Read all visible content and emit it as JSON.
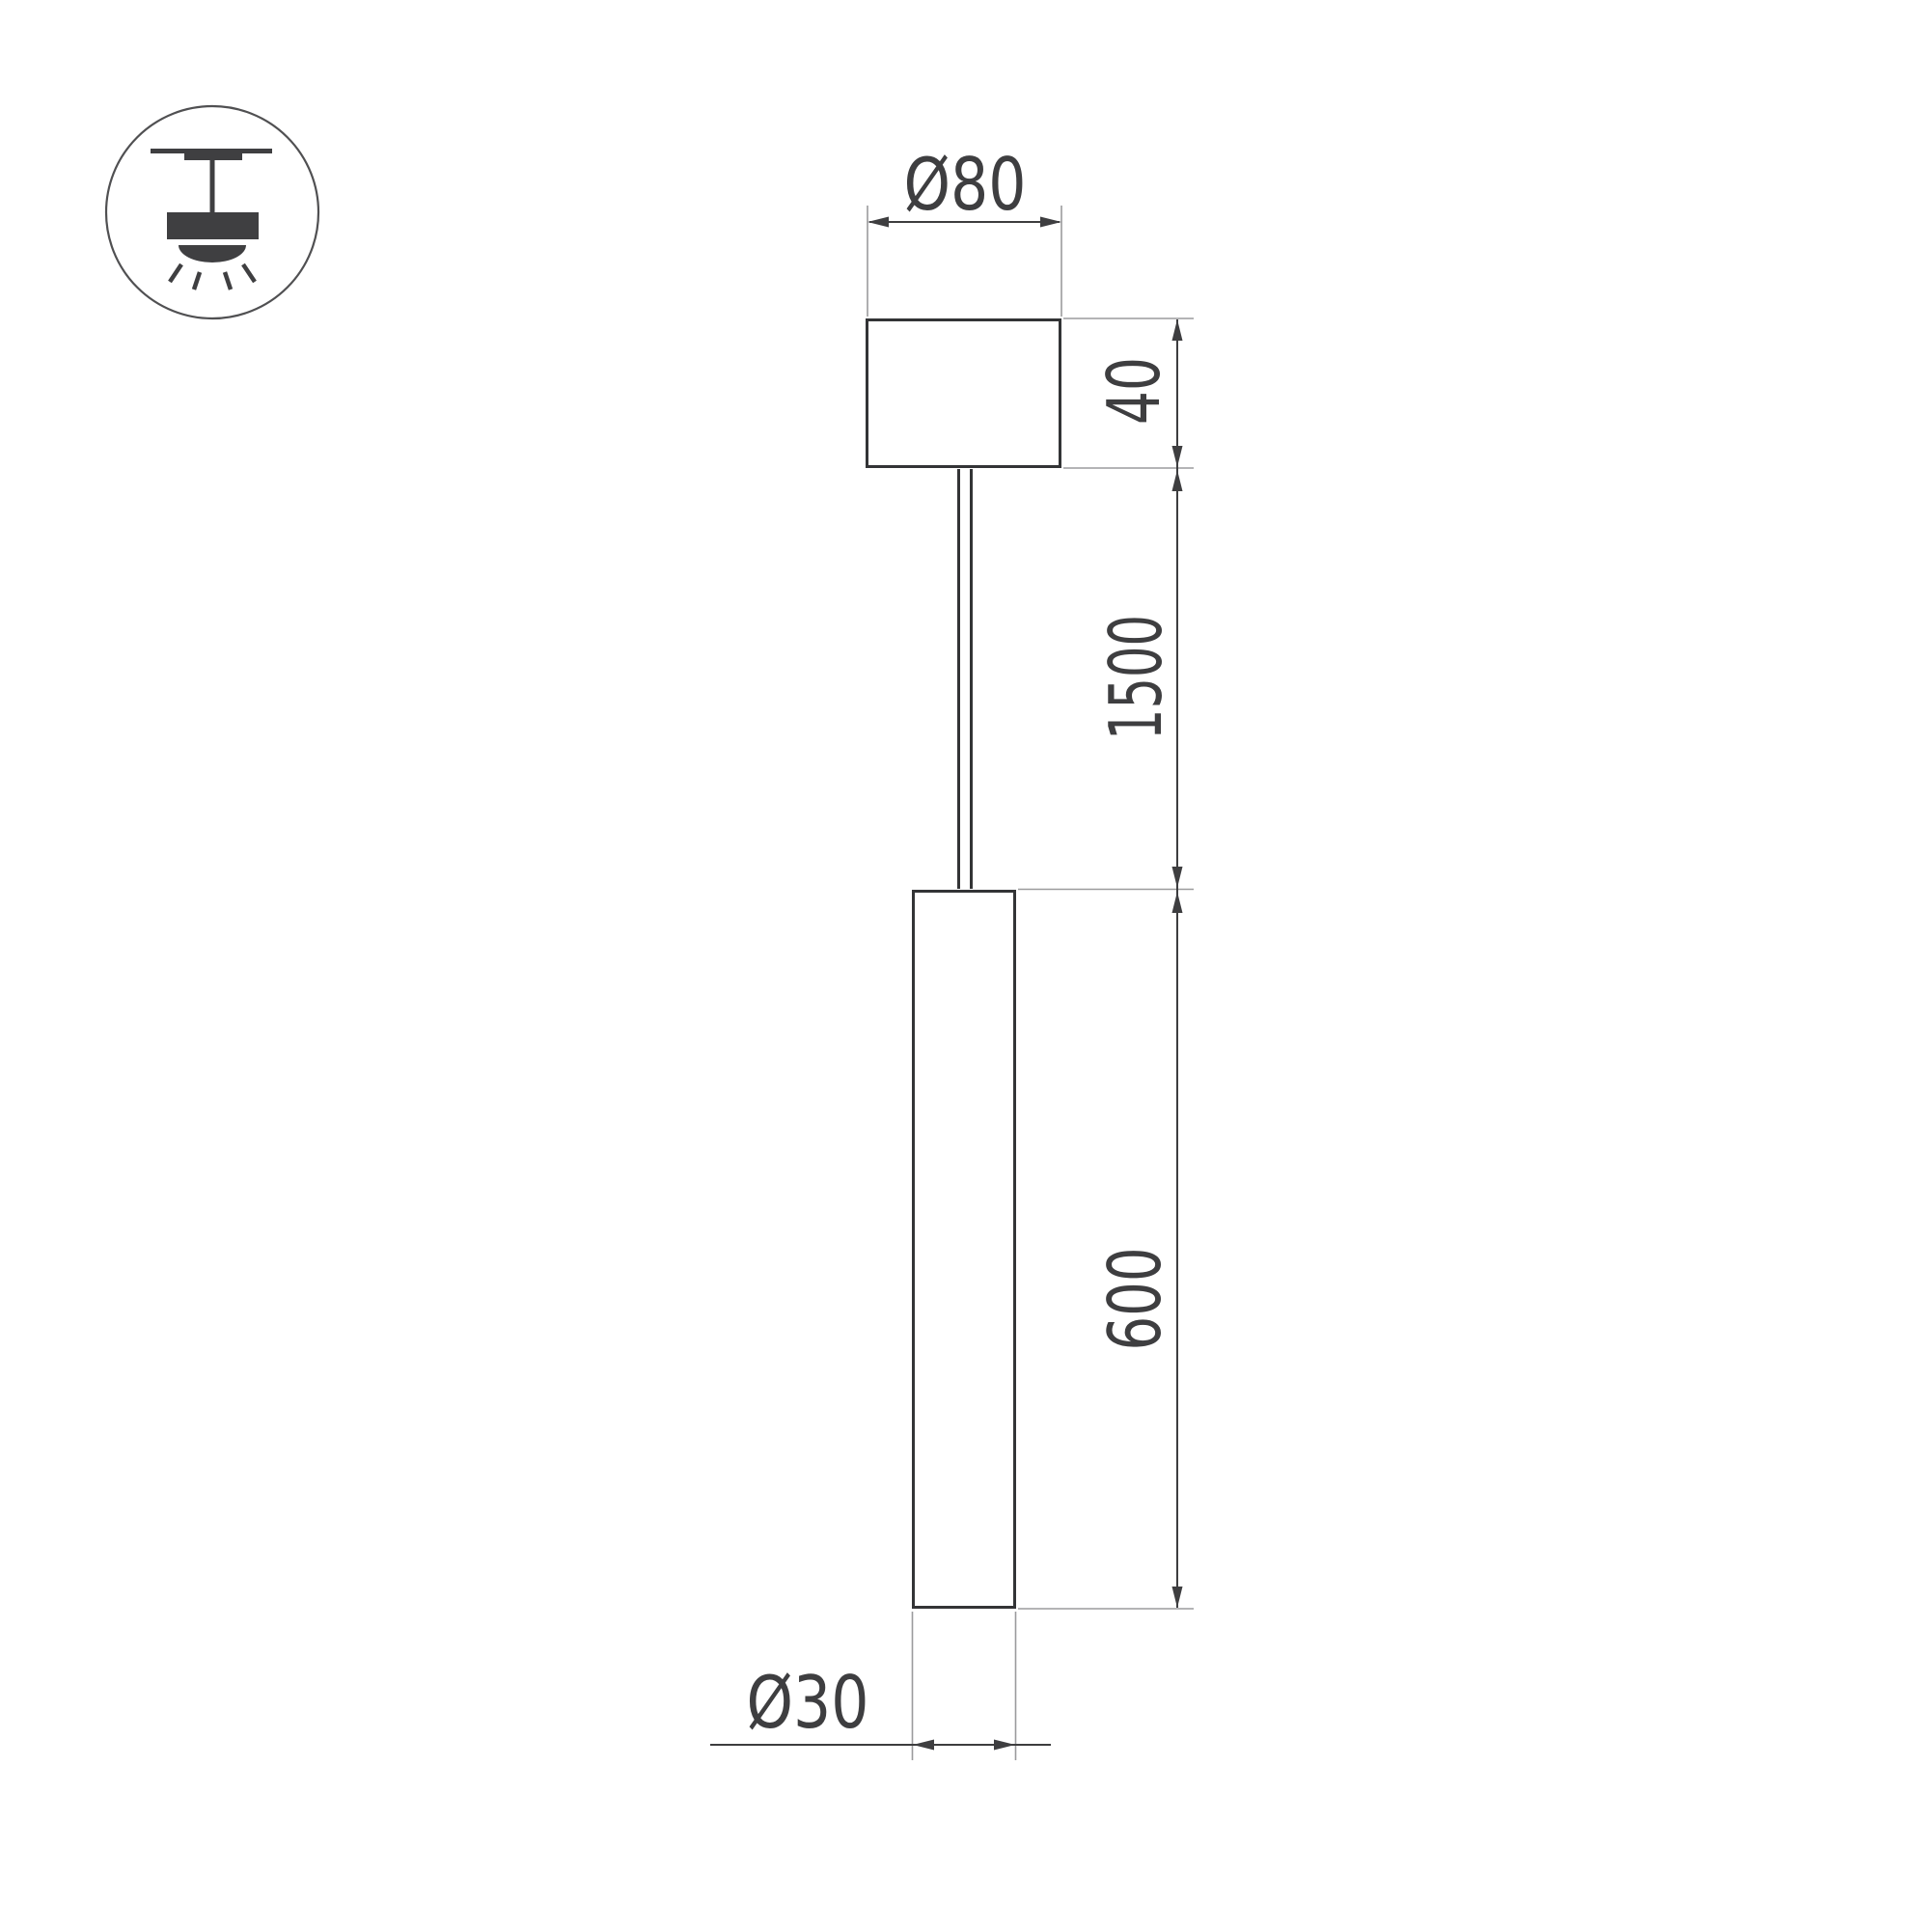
{
  "drawing": {
    "kind": "pendant-lamp-dimension-drawing",
    "background": "#ffffff"
  },
  "colors": {
    "outline": "#333436",
    "dimension_line": "#3d3d3f",
    "extension_line": "#9b9b9d",
    "arrow_fill": "#3e3e40",
    "text": "#3e3e40",
    "icon_fill": "#3f3f41",
    "icon_circle_stroke": "#505052"
  },
  "icon": {
    "name": "pendant-ceiling-light-icon"
  },
  "dimensions": {
    "canopy_diameter_label": "Ø80",
    "canopy_height_label": "40",
    "suspension_length_label": "1500",
    "tube_length_label": "600",
    "tube_diameter_label": "Ø30"
  }
}
